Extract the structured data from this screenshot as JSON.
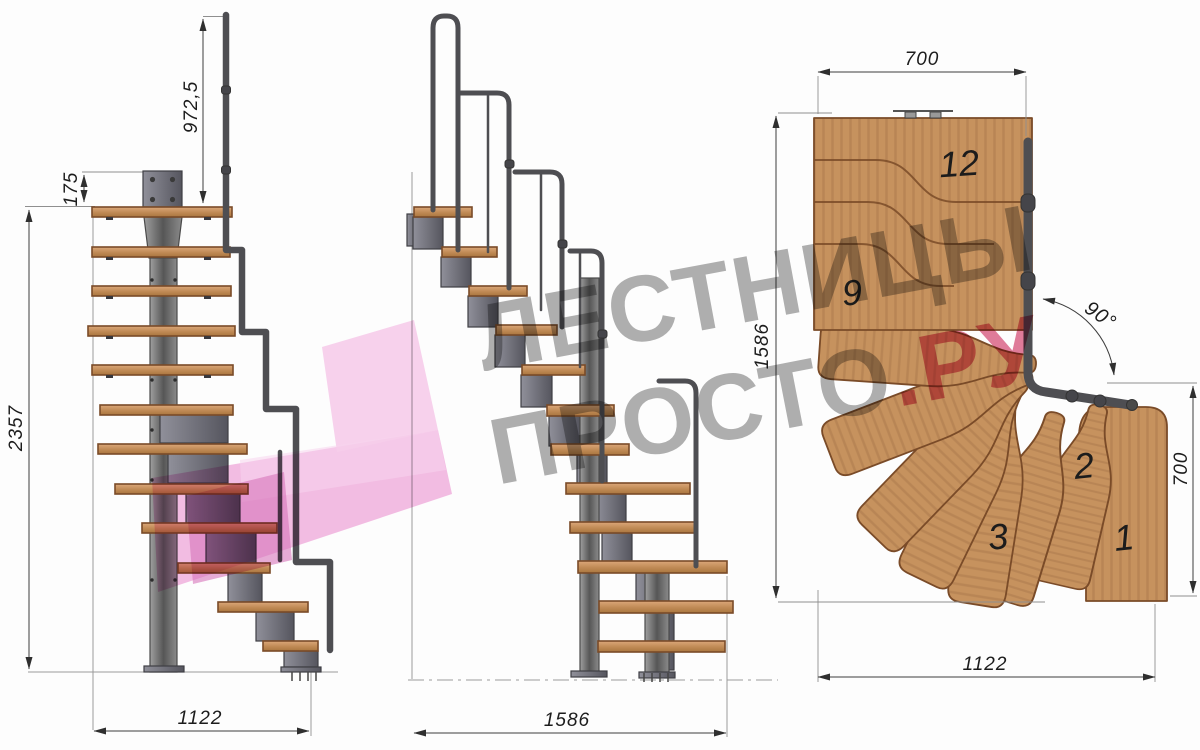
{
  "drawing": {
    "front_view": {
      "dim_rail_height": "972,5",
      "dim_plate": "175",
      "dim_total_height": "2357",
      "dim_width": "1122"
    },
    "side_view": {
      "dim_length": "1586"
    },
    "plan_view": {
      "dim_top_width": "700",
      "dim_left_length": "1586",
      "dim_right_width": "700",
      "dim_bottom_width": "1122",
      "dim_turn_angle": "90°",
      "step_labels": {
        "s1": "1",
        "s2": "2",
        "s3": "3",
        "s9": "9",
        "s12": "12"
      }
    }
  },
  "watermark": {
    "line1": "ЛЕСТНИЦЫ",
    "line2_main": "ПРОСТО",
    "line2_suffix": ".РУ"
  },
  "colors": {
    "wood": "#c6925e",
    "wood_edge": "#7a4b28",
    "metal": "#7d7d84",
    "rail": "#4e4e52",
    "dim_line": "#3d3d3d",
    "watermark_pink": "#f0aedd",
    "watermark_gray": "#9a9a9a",
    "watermark_red": "#cf3b63"
  }
}
